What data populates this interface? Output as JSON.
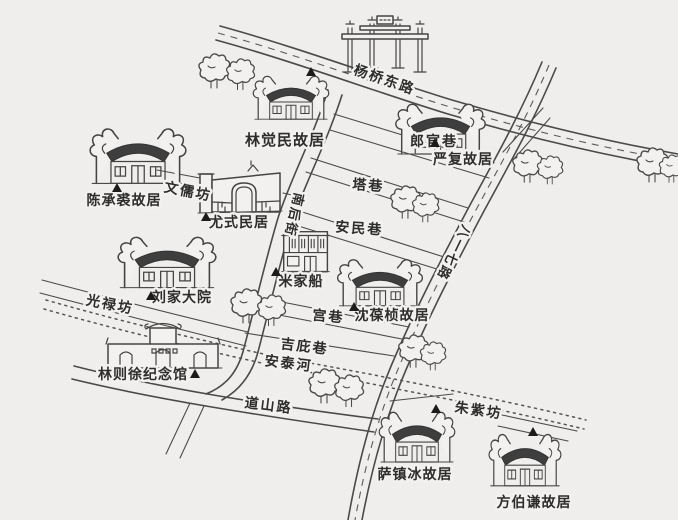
{
  "canvas": {
    "width": 678,
    "height": 520
  },
  "colors": {
    "paper": "#f2f1ef",
    "ink": "#4a4a4a",
    "roof": "#3e3e3e",
    "label": "#2d2d2d",
    "marker": "#1b1b1b"
  },
  "icons": {
    "site_marker": "black-triangle",
    "tree": "hand-drawn-tree",
    "archway": "paifang-gate"
  },
  "roads": {
    "yangqiao_dong_lu": "杨桥东路",
    "nanhou_jie": "南后街",
    "bayiqi_lu": "八一七路",
    "daoshan_lu": "道山路"
  },
  "lanes": {
    "langguan_xiang": "郎官巷",
    "ta_xiang": "塔巷",
    "anmin_xiang": "安民巷",
    "gong_xiang": "宫巷",
    "jibi_xiang": "吉庇巷",
    "wenru_fang": "文儒坊",
    "guanglu_fang": "光禄坊",
    "zhuzi_fang": "朱紫坊"
  },
  "river": {
    "antai_he": "安泰河"
  },
  "sites": {
    "lin_juemin": "林觉民故居",
    "yan_fu": "严复故居",
    "chen_chengqiu": "陈承裘故居",
    "you_shi": "尤式民居",
    "liu_jia": "刘家大院",
    "mi_jia_chuan": "米家船",
    "shen_baozhen": "沈葆桢故居",
    "lin_zexu": "林则徐纪念馆",
    "sa_zhenbing": "萨镇冰故居",
    "fang_boqian": "方伯谦故居"
  }
}
